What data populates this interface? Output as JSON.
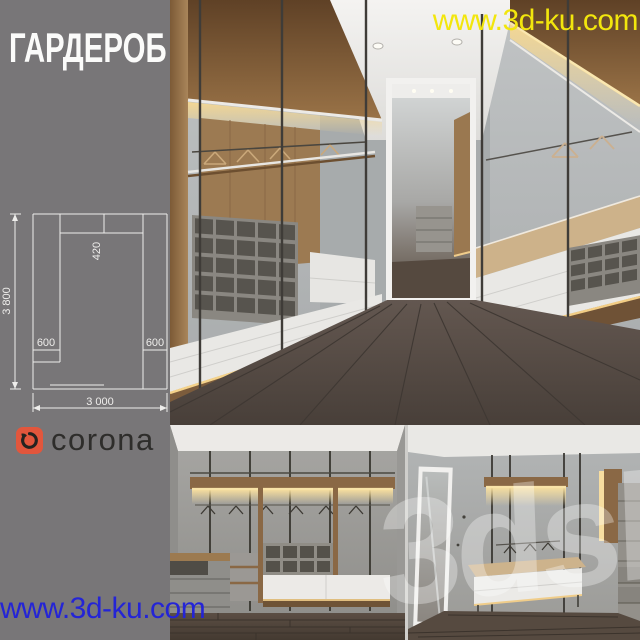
{
  "title": "ГАРДЕРОБ",
  "watermarks": {
    "top": "www.3d-ku.com",
    "bottom_left": "www.3d-ku.com",
    "overlay": "3dsky"
  },
  "logo": {
    "text": "corona"
  },
  "floor_plan": {
    "total_height": "3 800",
    "top_depth": "420",
    "left_depth": "600",
    "right_depth": "600",
    "total_width": "3 000"
  },
  "palette": {
    "background_gray": "#787678",
    "watermark_yellow": "#f2e60d",
    "watermark_blue": "#2424d6",
    "logo_orange": "#e2563c",
    "diagram_line_white": "#eeedeb",
    "wood": "#8a6845",
    "led_warm": "#f6d894",
    "wall_gray": "#b3b6b7",
    "floor_brown": "#55493f",
    "drawer_white": "#eae9e6"
  }
}
